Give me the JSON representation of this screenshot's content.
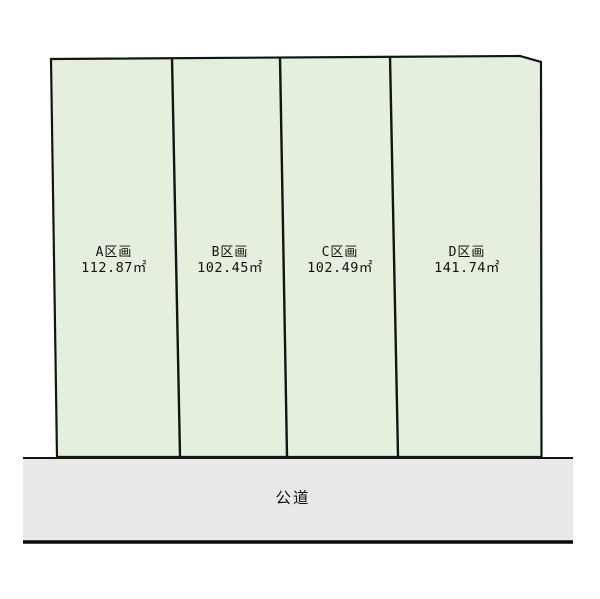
{
  "diagram": {
    "kind": "land-parcel-subdivision-plan",
    "parcels": [
      {
        "name": "A区画",
        "area": "112.87㎡"
      },
      {
        "name": "B区画",
        "area": "102.45㎡"
      },
      {
        "name": "C区画",
        "area": "102.49㎡"
      },
      {
        "name": "D区画",
        "area": "141.74㎡"
      }
    ],
    "road_label": "公道",
    "colors": {
      "parcel_fill": "#e4f0dd",
      "road_fill": "#e8e8e8",
      "outline": "#141414",
      "label_text": "#111111",
      "background": "#ffffff"
    }
  }
}
